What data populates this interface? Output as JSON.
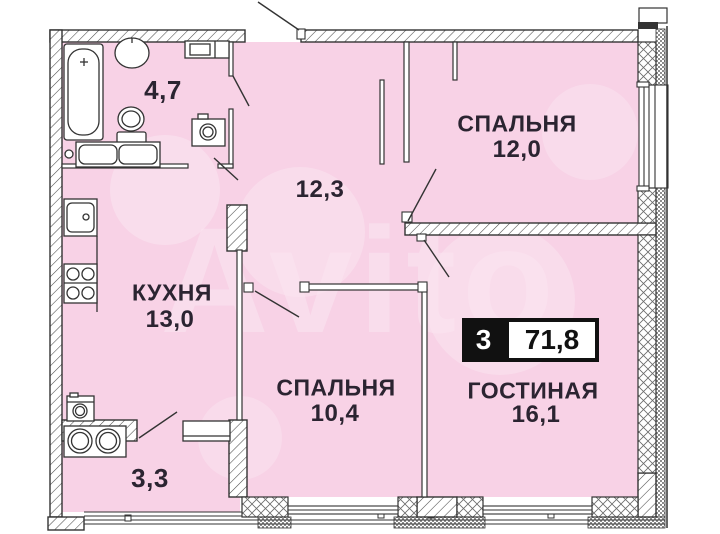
{
  "watermark": {
    "text": "Avito"
  },
  "badge": {
    "rooms": "3",
    "area": "71,8"
  },
  "rooms": {
    "bathroom": {
      "area": "4,7"
    },
    "hallway": {
      "area": "12,3"
    },
    "bedroom_top": {
      "label": "СПАЛЬНЯ",
      "area": "12,0"
    },
    "kitchen": {
      "label": "КУХНЯ",
      "area": "13,0"
    },
    "bedroom_bottom": {
      "label": "СПАЛЬНЯ",
      "area": "10,4"
    },
    "living": {
      "label": "ГОСТИНАЯ",
      "area": "16,1"
    },
    "laundry": {
      "area": "3,3"
    }
  },
  "colors": {
    "room_fill": "#f8d2e6",
    "line": "#333333",
    "text": "#2b2431",
    "badge_bg": "#111111"
  }
}
